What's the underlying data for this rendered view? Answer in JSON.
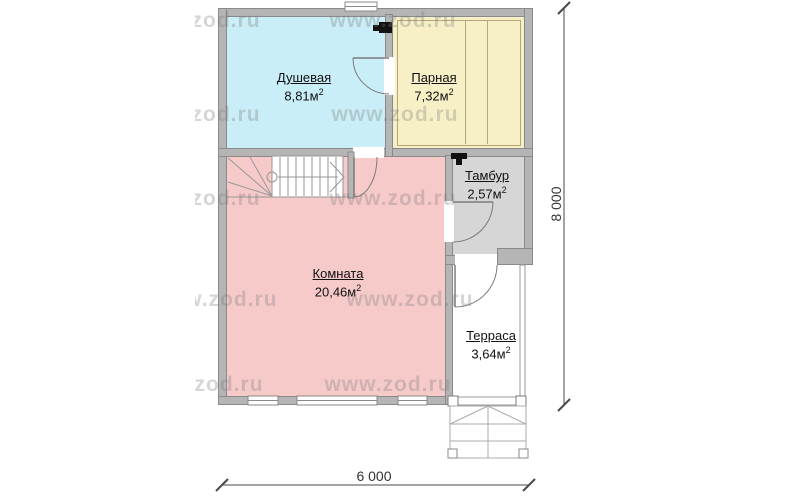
{
  "plan": {
    "title": "sauna-first-floor-plan",
    "rooms": [
      {
        "id": "shower",
        "name": "Душевая",
        "area": "8,81м",
        "area_sup": "2",
        "color": "#c9eef7"
      },
      {
        "id": "steam",
        "name": "Парная",
        "area": "7,32м",
        "area_sup": "2",
        "color": "#f7f0c7"
      },
      {
        "id": "vestibule",
        "name": "Тамбур",
        "area": "2,57м",
        "area_sup": "2",
        "color": "#d6d6d6"
      },
      {
        "id": "living",
        "name": "Комната",
        "area": "20,46м",
        "area_sup": "2",
        "color": "#f7caca"
      },
      {
        "id": "terrace",
        "name": "Терраса",
        "area": "3,64м",
        "area_sup": "2",
        "color": "#ffffff"
      }
    ],
    "dimensions": {
      "width_label": "6 000",
      "height_label": "8 000"
    },
    "watermark": {
      "text": "www.zod.ru"
    },
    "colors": {
      "wall": "#b5b5b5",
      "wall_outline": "#8a8a8a",
      "shower": "#c9eef7",
      "steam": "#f7f0c7",
      "vestibule": "#d6d6d6",
      "living": "#f7caca",
      "page": "#ffffff"
    }
  }
}
